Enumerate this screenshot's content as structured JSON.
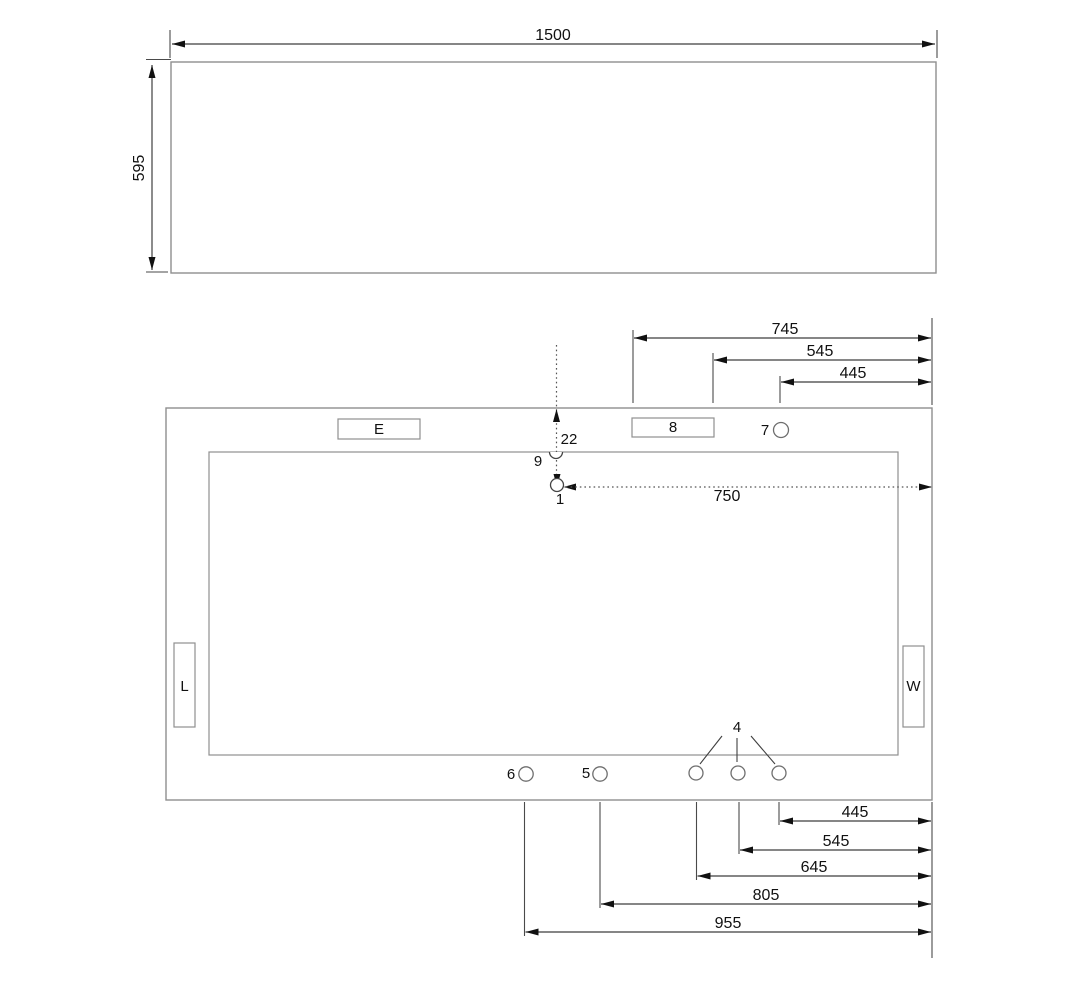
{
  "front_view": {
    "width_dim": "1500",
    "height_dim": "595"
  },
  "plan_view": {
    "component_labels": {
      "e": "E",
      "l": "L",
      "w": "W"
    },
    "point_labels": {
      "p1": "1",
      "p4": "4",
      "p5": "5",
      "p6": "6",
      "p7": "7",
      "p8": "8",
      "p9": "9",
      "p22": "22"
    },
    "dims_top": {
      "d745": "745",
      "d545": "545",
      "d445": "445"
    },
    "dim_center": {
      "d750": "750"
    },
    "dims_bottom": {
      "d445": "445",
      "d545": "545",
      "d645": "645",
      "d805": "805",
      "d955": "955"
    }
  },
  "colors": {
    "background": "#ffffff",
    "outline": "#8f8f8f",
    "dimension_line": "#3f3f3f",
    "text": "#111111",
    "arrow": "#111111"
  }
}
